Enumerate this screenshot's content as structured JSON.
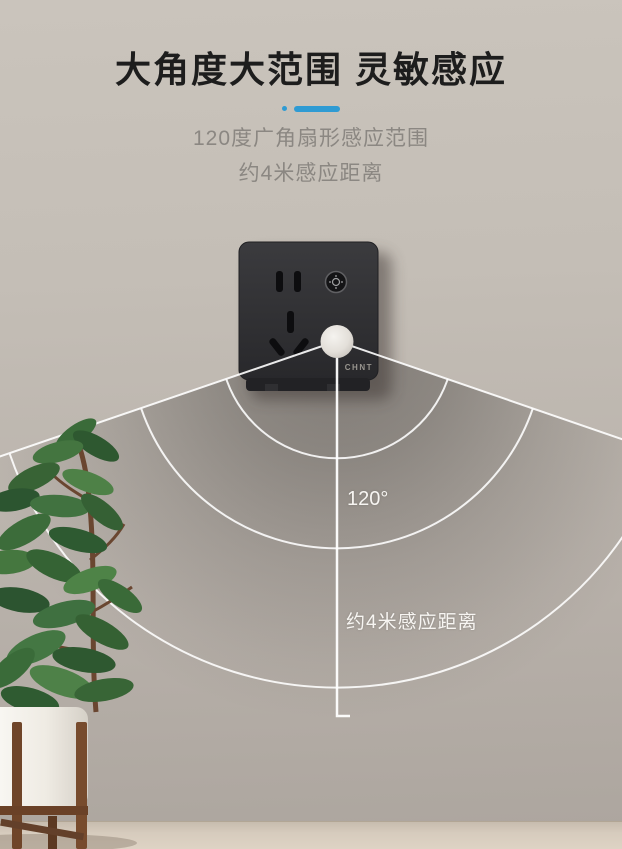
{
  "banner": {
    "title": "大角度大范围 灵敏感应",
    "subtitle_line1": "120度广角扇形感应范围",
    "subtitle_line2": "约4米感应距离"
  },
  "diagram": {
    "angle_label": "120°",
    "distance_label": "约4米感应距离"
  },
  "product": {
    "brand_logo": "CHNT"
  },
  "icons": {
    "sensor_button": "light-sensor-icon",
    "sensor_dome": "motion-sensor-dome"
  },
  "colors": {
    "accent_blue": "#2F9BD3",
    "title_text": "#1D1D1D",
    "subtitle_text": "#8B8782",
    "wall_top": "#CAC4BC",
    "wall_bottom": "#ACA59E",
    "floor": "#DED3C4",
    "socket_body": "#303033",
    "diagram_line": "#FFFFFF",
    "pot_white": "#FBFAF7",
    "stand_wood": "#6F4529",
    "leaf_green": "#3C6C3A"
  }
}
